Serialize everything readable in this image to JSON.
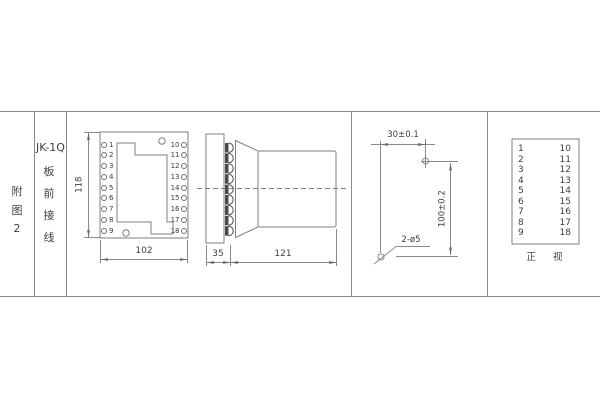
{
  "colors": {
    "line": "#8a8a8a",
    "text": "#3f3f3f",
    "terminal_fill": "#4a4a4a"
  },
  "index_column": {
    "chars": [
      "附",
      "图",
      "2"
    ]
  },
  "title_column": {
    "model": "JK-1Q",
    "chars": [
      "板",
      "前",
      "接",
      "线"
    ]
  },
  "front_view": {
    "left_pins": [
      "1",
      "2",
      "3",
      "4",
      "5",
      "6",
      "7",
      "8",
      "9"
    ],
    "right_pins": [
      "10",
      "11",
      "12",
      "13",
      "14",
      "15",
      "16",
      "17",
      "18"
    ],
    "height_dim": "118",
    "width_dim": "102"
  },
  "side_view": {
    "front_depth_dim": "35",
    "body_depth_dim": "121"
  },
  "drill_plan": {
    "horizontal_dim": "30±0.1",
    "vertical_dim": "100±0.2",
    "holes_label": "2-ø5"
  },
  "pin_table": {
    "left": [
      "1",
      "2",
      "3",
      "4",
      "5",
      "6",
      "7",
      "8",
      "9"
    ],
    "right": [
      "10",
      "11",
      "12",
      "13",
      "14",
      "15",
      "16",
      "17",
      "18"
    ],
    "caption": "正 视"
  }
}
